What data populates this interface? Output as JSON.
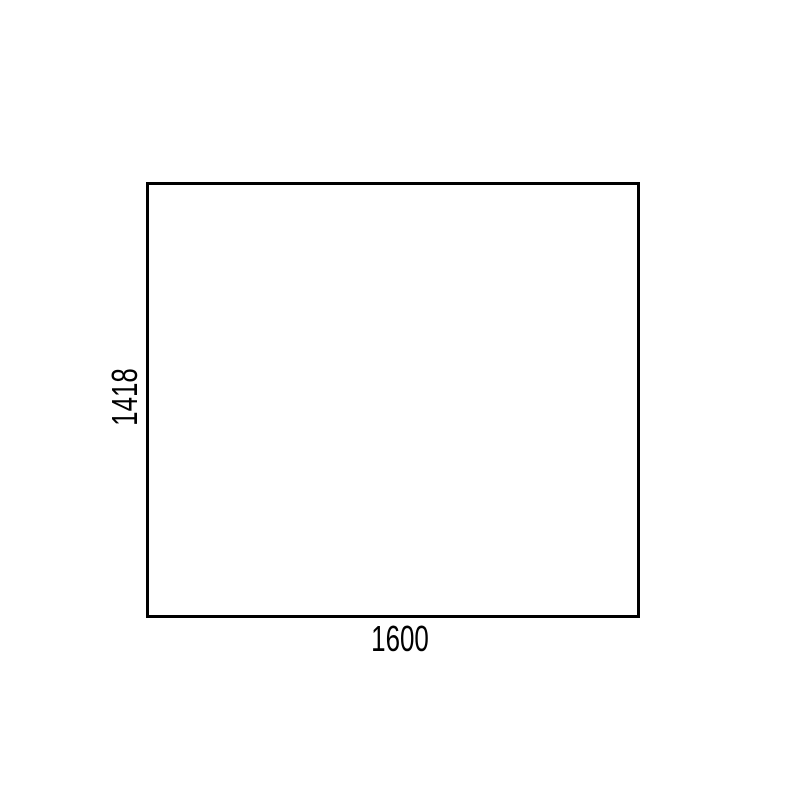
{
  "diagram": {
    "type": "dimension-drawing",
    "shape": "rectangle",
    "width_label": "1600",
    "height_label": "1418",
    "colors": {
      "background": "#ffffff",
      "line": "#000000",
      "text": "#000000"
    }
  }
}
